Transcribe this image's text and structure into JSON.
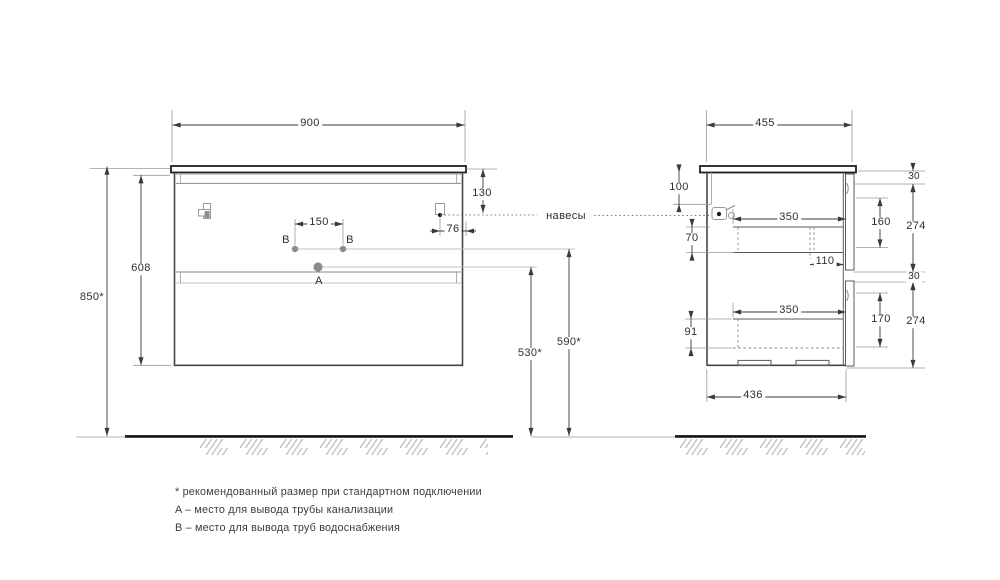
{
  "front_view": {
    "dims": {
      "width": "900",
      "overall_height": "850*",
      "cabinet_height": "608",
      "hinge_from_top": "130",
      "hinge_from_edge": "76",
      "supply_spacing": "150",
      "drain_from_floor": "530*",
      "supply_from_floor": "590*"
    },
    "markers": {
      "drain": "A",
      "supply": "B"
    }
  },
  "side_view": {
    "dims": {
      "depth": "455",
      "back_panel_top": "100",
      "top_clearance": "70",
      "drawer_width_top": "350",
      "drawer_width_bottom": "350",
      "back_clearance": "110",
      "drawer_height_top": "160",
      "drawer_height_bottom": "170",
      "front_height_top": "274",
      "front_height_bottom": "274",
      "reveal_top": "30",
      "reveal_mid": "30",
      "base_depth": "436",
      "drawer_side_bottom": "91"
    }
  },
  "labels": {
    "hangers": "навесы"
  },
  "footnotes": [
    "* рекомендованный размер при стандартном подключении",
    "A – место для вывода трубы канализации",
    "B – место для вывода труб водоснабжения"
  ]
}
